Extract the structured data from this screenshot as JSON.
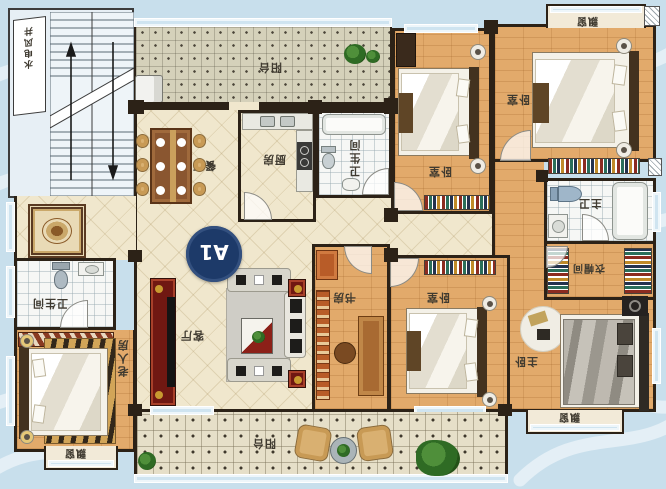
{
  "badge": {
    "label": "A1"
  },
  "labels": {
    "shaft": "水电风井",
    "balcony_top": "阳台",
    "dining": "餐厅",
    "kitchen": "厨房",
    "bath_center": "卫生间",
    "bedroom_top_left": "卧室",
    "bedroom_top_right": "卧室",
    "bay_top": "飘窗",
    "master_bath": "主卫",
    "closet": "衣帽间",
    "master_bedroom": "主卧",
    "bay_master": "飘窗",
    "bedroom_bottom": "卧室",
    "study": "书房",
    "living": "客厅",
    "bath_left": "卫生间",
    "elder_room": "老人房",
    "bay_elder": "飘窗",
    "balcony_bottom": "阳台"
  },
  "colors": {
    "background_blue": "#c8dfec",
    "wave_white": "#ffffff",
    "wall_dark": "#2c2217",
    "wood_floor": "#e2aa6b",
    "tile_cream": "#f0e7cd",
    "bath_tile": "#f6f7f5",
    "balcony_tile_top": "#d5d1ba",
    "balcony_tile_bottom": "#e6dfc8",
    "badge_navy": "#1d3a69",
    "tv_cabinet_red": "#701812",
    "bookshelf_orange": "#b85c28"
  },
  "orientation_note": "plan labels rotated 180deg"
}
